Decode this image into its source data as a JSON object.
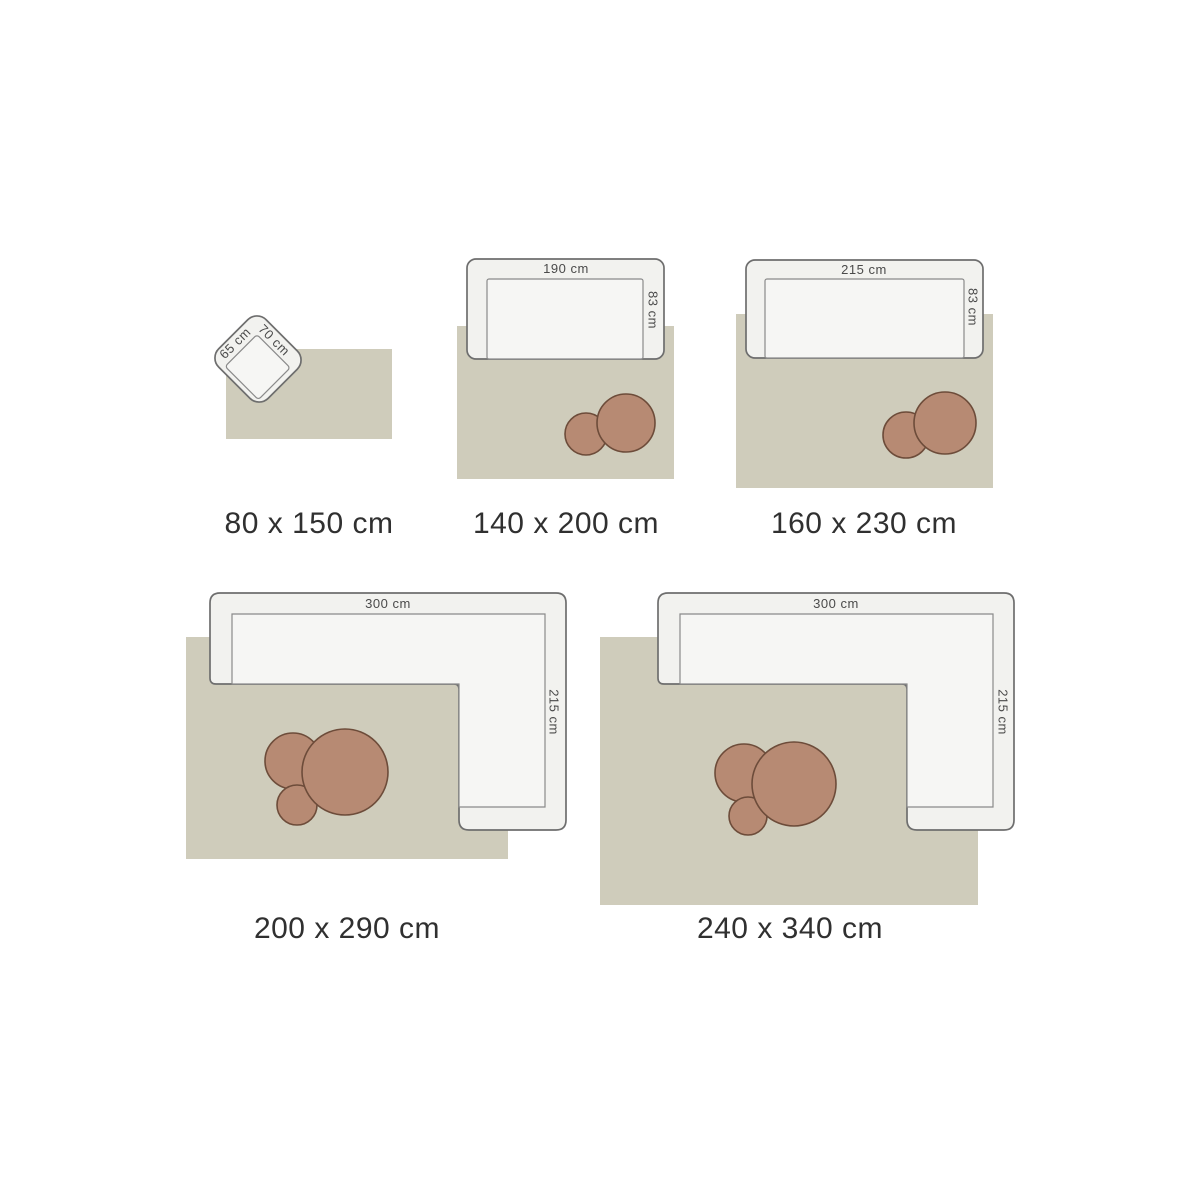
{
  "diagram": {
    "type": "rug-size-guide",
    "unit": "cm"
  },
  "colors": {
    "background": "#ffffff",
    "rug": "#cfccbb",
    "furniture_fill": "#f2f2ef",
    "furniture_seat_fill": "#f6f6f4",
    "furniture_outline": "#6e6e6e",
    "coffee_table_fill": "#b78a73",
    "coffee_table_outline": "#6d4c3a",
    "size_label_color": "#303030",
    "dimension_label_color": "#4a4a4a"
  },
  "scenes": [
    {
      "label": "80 x 150 cm",
      "furniture": "armchair",
      "furniture_width": "65 cm",
      "furniture_depth": "70 cm",
      "coffee_tables": 0
    },
    {
      "label": "140 x 200 cm",
      "furniture": "sofa",
      "furniture_width": "190 cm",
      "furniture_depth": "83 cm",
      "coffee_tables": 2
    },
    {
      "label": "160 x 230 cm",
      "furniture": "sofa",
      "furniture_width": "215 cm",
      "furniture_depth": "83 cm",
      "coffee_tables": 2
    },
    {
      "label": "200 x 290 cm",
      "furniture": "corner-sofa",
      "furniture_width": "300 cm",
      "furniture_depth": "215 cm",
      "coffee_tables": 3
    },
    {
      "label": "240 x 340 cm",
      "furniture": "corner-sofa",
      "furniture_width": "300 cm",
      "furniture_depth": "215 cm",
      "coffee_tables": 3
    }
  ]
}
